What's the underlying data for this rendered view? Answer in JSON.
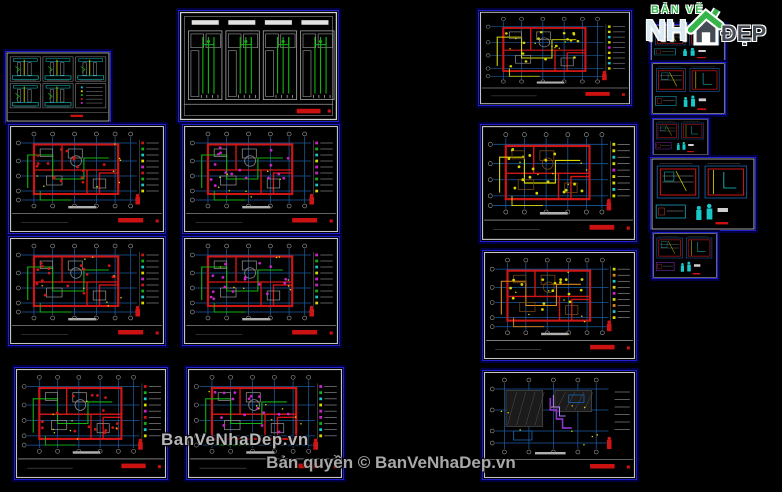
{
  "page": {
    "width": 782,
    "height": 492,
    "background": "#000000"
  },
  "branding": {
    "logo": {
      "line1": "BẢN VẼ",
      "nh": "NH",
      "dep": "ĐẸP"
    },
    "watermark": "BanVeNhaDep.vn",
    "copyright": "Bản quyền © BanVeNhaDep.vn"
  },
  "colors": {
    "background": "#000000",
    "panel_border": "#2121cc",
    "panel_glow": "#000042",
    "sheet_frame": "#c4c4c4",
    "grid_blue": "#1b5a9e",
    "wall_red": "#cf1616",
    "wire_green": "#12b212",
    "cyan": "#18c8c8",
    "yellow": "#d8d800",
    "magenta": "#cc22cc",
    "orange": "#e08818",
    "purple": "#8833cc",
    "brown": "#7a4616",
    "title_red": "#cc1111",
    "watermark_gray": "#b6b6b6",
    "logo_green": "#35b54a",
    "logo_nh": "#d9eaf2",
    "logo_dep": "#454b55"
  },
  "panels": [
    {
      "id": "sheet-section-details",
      "label": "Section detail sheet",
      "type": "details",
      "x": 5,
      "y": 51,
      "w": 106,
      "h": 72,
      "seed": 3
    },
    {
      "id": "sheet-electrical-plan-1",
      "label": "Electrical layout floor plan 1",
      "type": "floor",
      "x": 8,
      "y": 124,
      "w": 158,
      "h": 110,
      "accent": "wire_green",
      "dots": "wall_red",
      "seed": 11
    },
    {
      "id": "sheet-electrical-plan-2",
      "label": "Electrical layout floor plan 2",
      "type": "floor",
      "x": 8,
      "y": 236,
      "w": 158,
      "h": 110,
      "accent": "wire_green",
      "dots": "wall_red",
      "seed": 12
    },
    {
      "id": "sheet-electrical-plan-3",
      "label": "Electrical layout floor plan 3",
      "type": "floor",
      "x": 14,
      "y": 367,
      "w": 154,
      "h": 113,
      "accent": "wire_green",
      "dots": "wall_red",
      "seed": 13
    },
    {
      "id": "sheet-riser-diagrams",
      "label": "Electrical riser diagrams",
      "type": "riser",
      "x": 178,
      "y": 10,
      "w": 161,
      "h": 112,
      "seed": 5
    },
    {
      "id": "sheet-lighting-plan-1",
      "label": "Lighting layout floor plan 1",
      "type": "floor",
      "x": 182,
      "y": 124,
      "w": 158,
      "h": 110,
      "accent": "wire_green",
      "dots": "magenta",
      "seed": 21
    },
    {
      "id": "sheet-lighting-plan-2",
      "label": "Lighting layout floor plan 2",
      "type": "floor",
      "x": 182,
      "y": 236,
      "w": 158,
      "h": 110,
      "accent": "wire_green",
      "dots": "magenta",
      "seed": 22
    },
    {
      "id": "sheet-lighting-plan-3",
      "label": "Lighting layout floor plan 3",
      "type": "floor",
      "x": 186,
      "y": 367,
      "w": 158,
      "h": 113,
      "accent": "wire_green",
      "dots": "magenta",
      "seed": 23
    },
    {
      "id": "sheet-plumbing-plan-1",
      "label": "Plumbing floor plan 1",
      "type": "floor",
      "x": 478,
      "y": 10,
      "w": 154,
      "h": 96,
      "accent": "yellow",
      "dots": "yellow",
      "seed": 31
    },
    {
      "id": "sheet-plumbing-plan-2",
      "label": "Plumbing floor plan 2",
      "type": "floor",
      "x": 480,
      "y": 124,
      "w": 157,
      "h": 118,
      "accent": "yellow",
      "dots": "yellow",
      "furn": "brown",
      "seed": 32
    },
    {
      "id": "sheet-plumbing-plan-3",
      "label": "Plumbing floor plan 3",
      "type": "floor",
      "x": 482,
      "y": 250,
      "w": 155,
      "h": 111,
      "accent": "orange",
      "dots": "yellow",
      "furn": "brown",
      "seed": 33
    },
    {
      "id": "sheet-roof-plan",
      "label": "Roof plan",
      "type": "roof",
      "x": 482,
      "y": 370,
      "w": 155,
      "h": 110,
      "seed": 41
    },
    {
      "id": "sheet-detail-a",
      "label": "Detail sheet A",
      "type": "pair",
      "x": 650,
      "y": 24,
      "w": 76,
      "h": 38,
      "seed": 51
    },
    {
      "id": "sheet-detail-b",
      "label": "Detail sheet B",
      "type": "pair",
      "x": 651,
      "y": 62,
      "w": 75,
      "h": 53,
      "seed": 52
    },
    {
      "id": "sheet-detail-c",
      "label": "Detail sheet C",
      "type": "pair",
      "x": 652,
      "y": 118,
      "w": 57,
      "h": 38,
      "variant": "purple",
      "seed": 53
    },
    {
      "id": "sheet-detail-d",
      "label": "Detail sheet D",
      "type": "pair",
      "x": 650,
      "y": 157,
      "w": 106,
      "h": 74,
      "seed": 54
    },
    {
      "id": "sheet-detail-e",
      "label": "Detail sheet E",
      "type": "pair",
      "x": 652,
      "y": 232,
      "w": 66,
      "h": 47,
      "variant": "purple",
      "seed": 55
    }
  ]
}
